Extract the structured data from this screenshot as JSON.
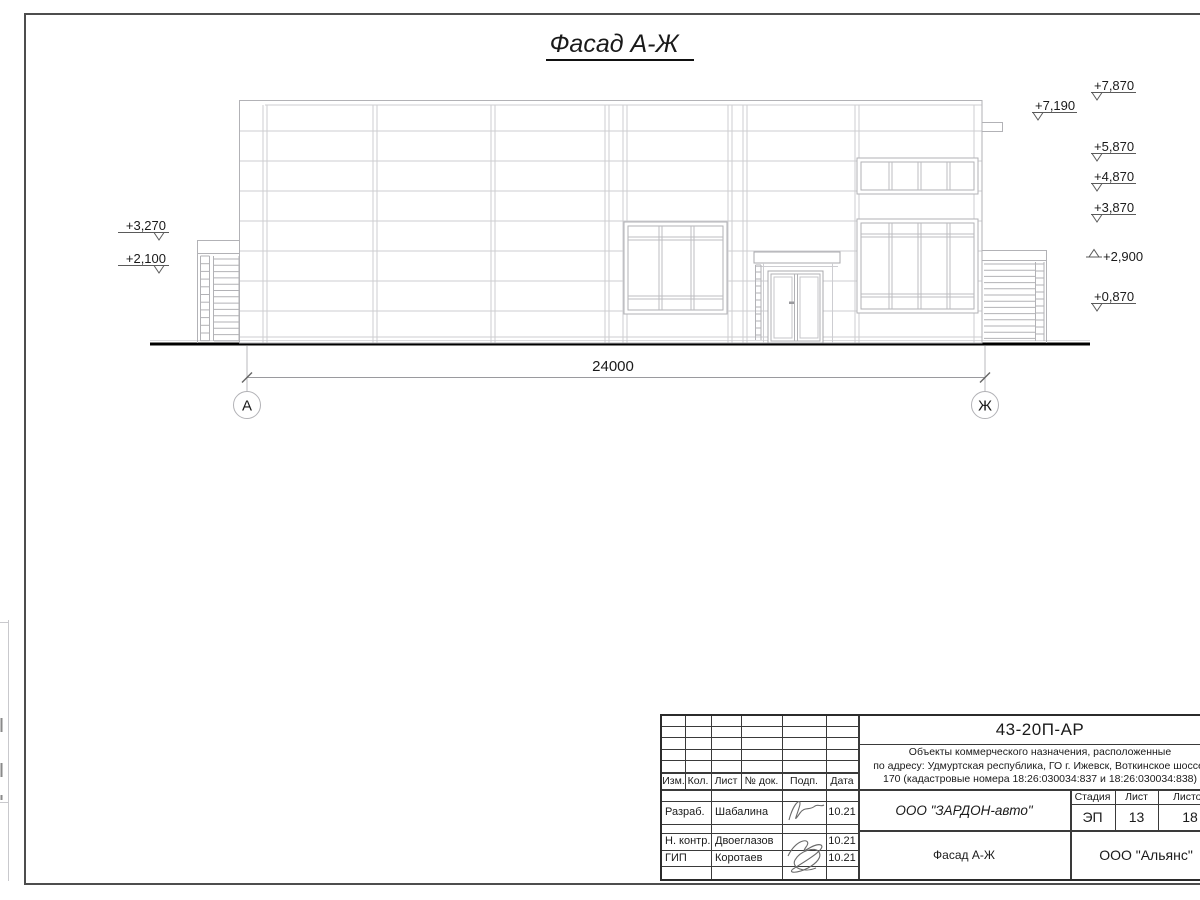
{
  "page": {
    "title": "Фасад А-Ж"
  },
  "drawing": {
    "dimension": "24000",
    "axis_left": "А",
    "axis_right": "Ж",
    "elev_left": [
      "+3,270",
      "+2,100"
    ],
    "elev_right": [
      "+7,870",
      "+7,190",
      "+5,870",
      "+4,870",
      "+3,870",
      "+2,900",
      "+0,870"
    ]
  },
  "colors": {
    "ink": "#1a1a1a",
    "line_light": "#c9c9cd",
    "line_medium": "#aaaaae"
  },
  "title_block": {
    "doc_number": "43-20П-АР",
    "description_line1": "Объекты коммерческого назначения, расположенные",
    "description_line2": "по адресу: Удмуртская республика, ГО г. Ижевск, Воткинское шоссе,",
    "description_line3": "170 (кадастровые номера 18:26:030034:837 и 18:26:030034:838)",
    "rev_cols": [
      "Изм.",
      "Кол.",
      "Лист",
      "№ док.",
      "Подп.",
      "Дата"
    ],
    "sign_rows": [
      {
        "role": "Разраб.",
        "name": "Шабалина",
        "date": "10.21"
      },
      {
        "role": "Н. контр.",
        "name": "Двоеглазов",
        "date": "10.21"
      },
      {
        "role": "ГИП",
        "name": "Коротаев",
        "date": "10.21"
      }
    ],
    "company": "ООО \"ЗАРДОН-авто\"",
    "drawing_title": "Фасад А-Ж",
    "stage_label": "Стадия",
    "sheet_label": "Лист",
    "sheets_label": "Листов",
    "stage": "ЭП",
    "sheet": "13",
    "sheets": "18",
    "org": "ООО \"Альянс\""
  }
}
